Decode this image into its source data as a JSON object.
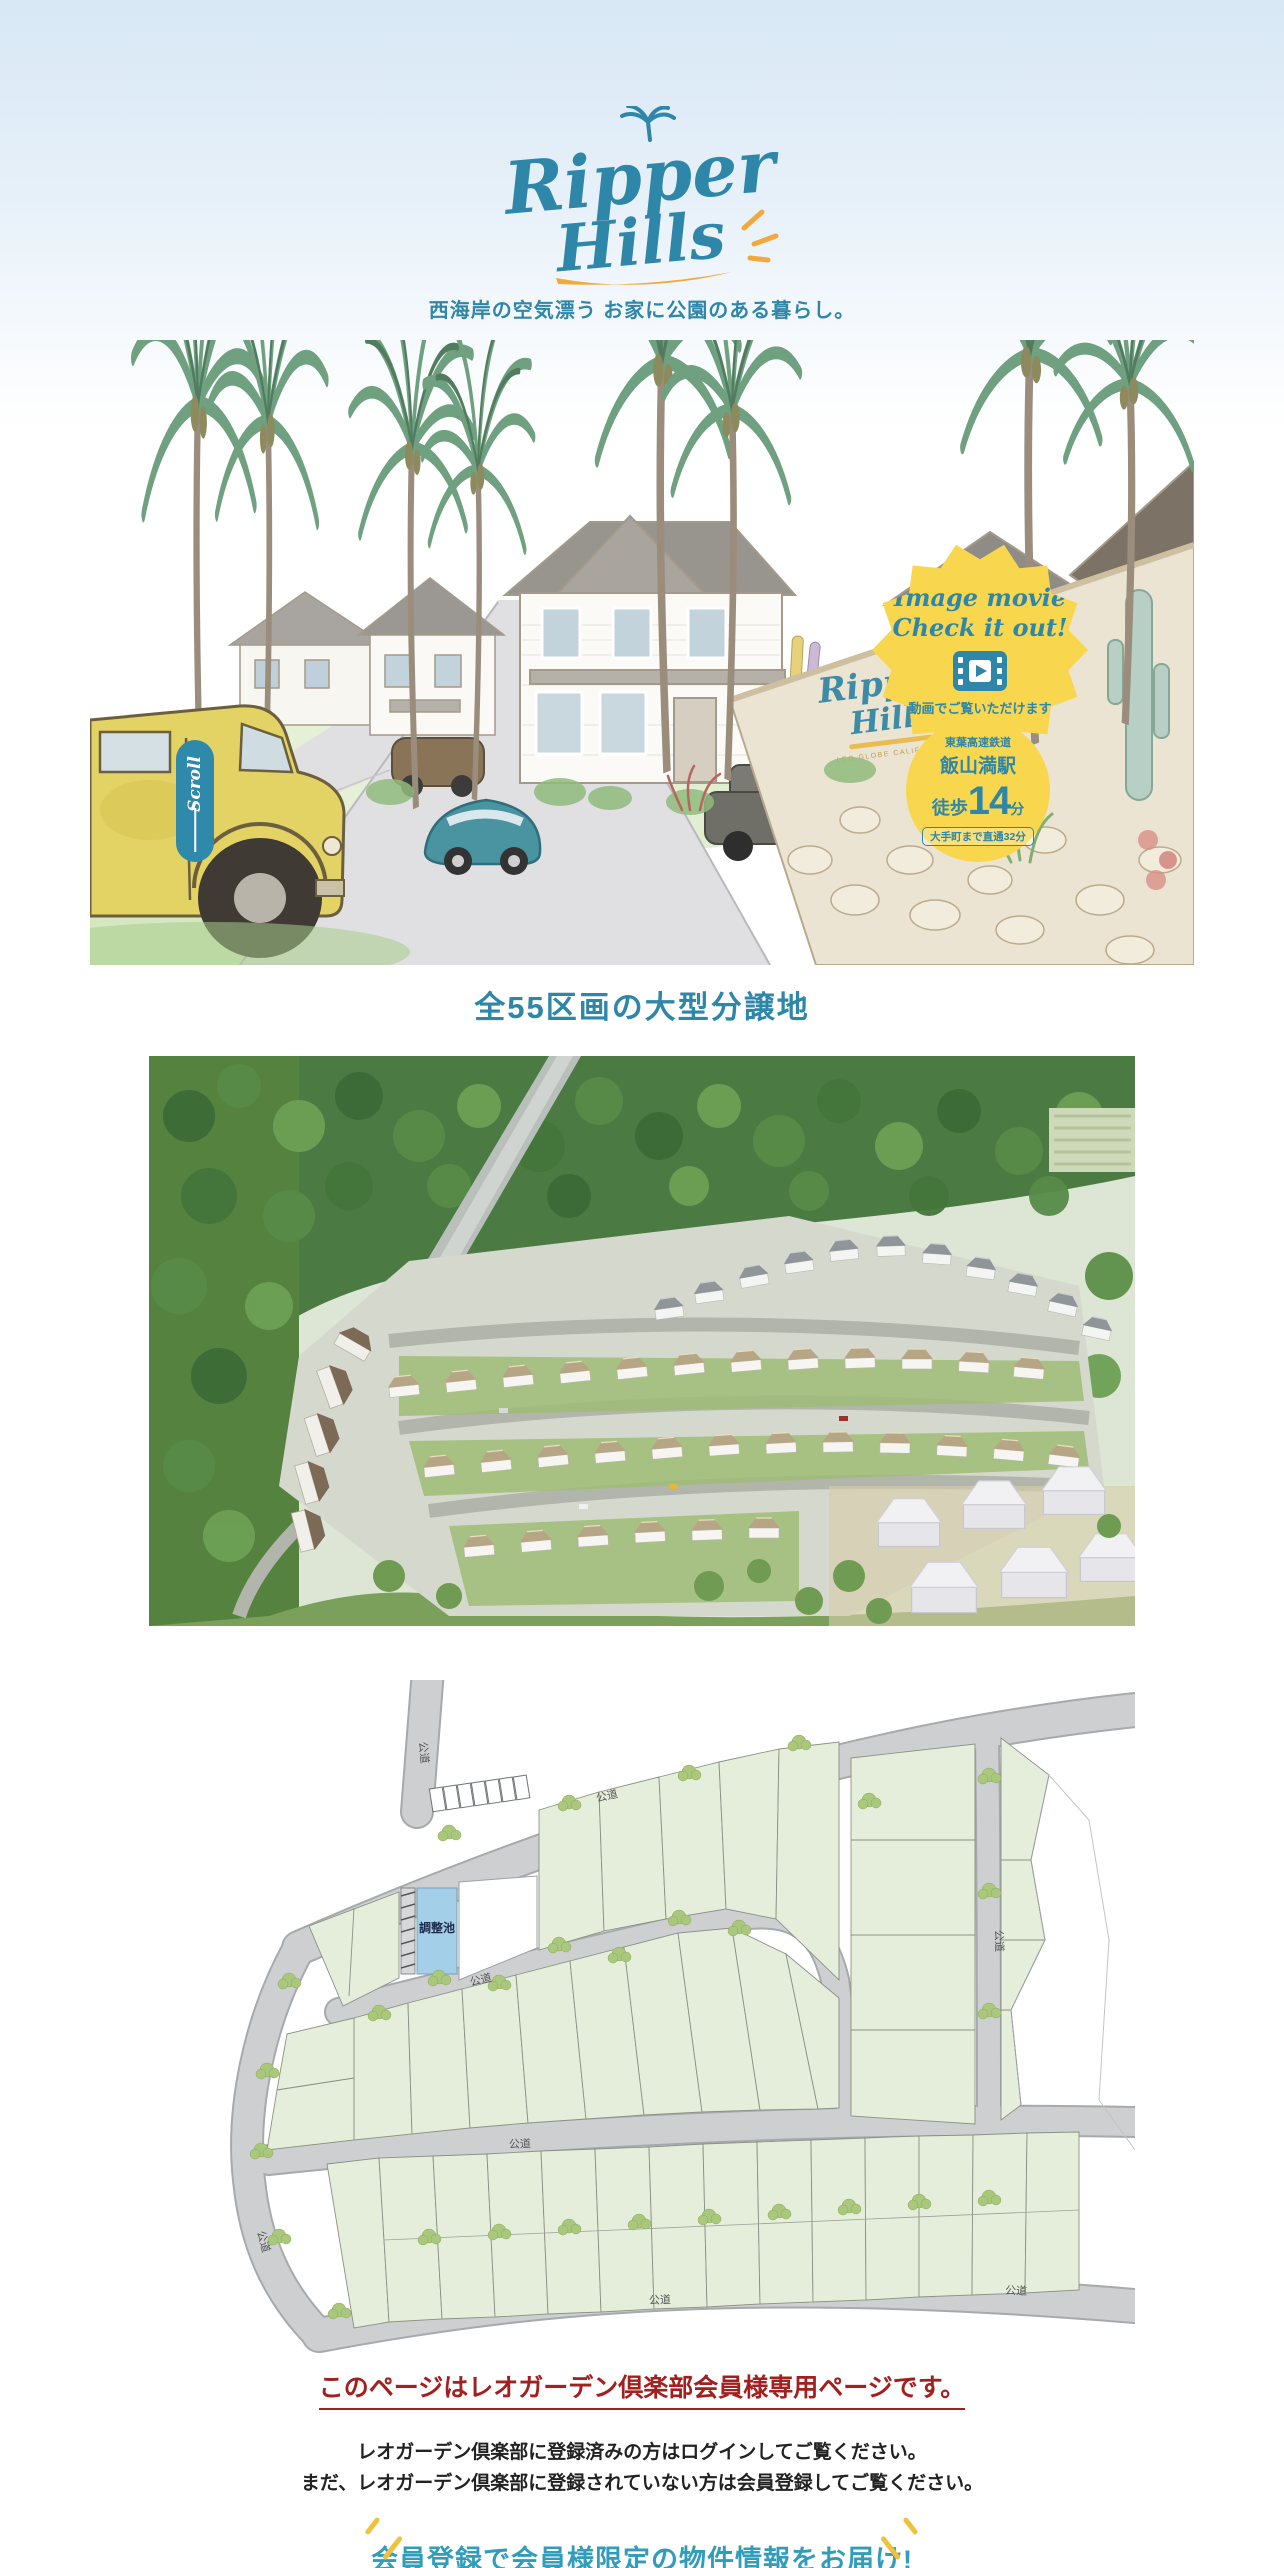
{
  "logo": {
    "word1": "Ripper",
    "word2": "Hills"
  },
  "tagline": "西海岸の空気漂う お家に公園のある暮らし。",
  "hero": {
    "scroll_label": "Scroll",
    "movie_badge": {
      "line1": "Image movie",
      "line2": "Check it out!",
      "icon": "video-play-icon",
      "caption": "動画でご覧いただけます"
    },
    "station_badge": {
      "railway": "東葉高速鉄道",
      "station": "飯山満駅",
      "walk_prefix": "徒歩",
      "walk_minutes": "14",
      "walk_unit": "分",
      "direct_access": "大手町まで直通32分"
    },
    "sign": {
      "word1": "Ripper",
      "word2": "Hills",
      "subtitle": "LEO GLOBE CALIFORNIA"
    }
  },
  "sections": {
    "lots_heading": "全55区画の大型分譲地"
  },
  "siteplan": {
    "pond_label": "調整池",
    "road_label": "公道"
  },
  "member": {
    "notice": "このページはレオガーデン倶楽部会員様専用ページです。",
    "instruction1": "レオガーデン倶楽部に登録済みの方はログインしてご覧ください。",
    "instruction2": "まだ、レオガーデン倶楽部に登録されていない方は会員登録してご覧ください。",
    "cta": "会員登録で会員様限定の物件情報をお届け!"
  },
  "colors": {
    "teal": "#2e86a8",
    "badge_yellow": "#f8d64e",
    "accent_yellow": "#f0a93a",
    "notice_red": "#a32020",
    "cta_teal": "#319dbb"
  }
}
